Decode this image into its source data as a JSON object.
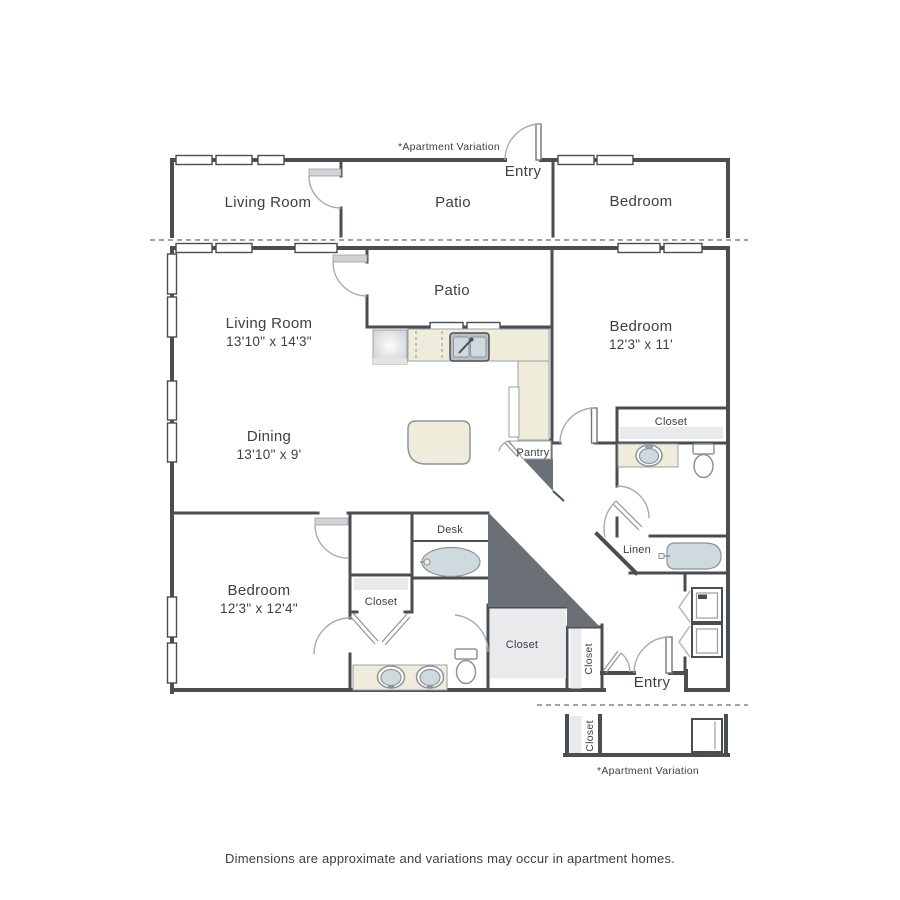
{
  "top_variation": {
    "note": "*Apartment Variation",
    "entry": "Entry",
    "living_room": "Living Room",
    "patio": "Patio",
    "bedroom": "Bedroom"
  },
  "unit": {
    "patio": "Patio",
    "living_room": {
      "name": "Living Room",
      "dims": "13'10\" x 14'3\""
    },
    "dining": {
      "name": "Dining",
      "dims": "13'10\" x 9'"
    },
    "bedroom_right": {
      "name": "Bedroom",
      "dims": "12'3\" x 11'"
    },
    "bedroom_left": {
      "name": "Bedroom",
      "dims": "12'3\" x 12'4\""
    },
    "pantry": "Pantry",
    "desk": "Desk",
    "linen": "Linen",
    "entry": "Entry",
    "closet_bedroom_right": "Closet",
    "closet_bedroom_left": "Closet",
    "closet_walk_in": "Closet",
    "closet_hall": "Closet"
  },
  "bottom_variation": {
    "note": "*Apartment Variation",
    "closet": "Closet"
  },
  "footer": "Dimensions are approximate and variations may occur in apartment homes.",
  "colors": {
    "wall": "#494e53",
    "counter": "#efecdb",
    "fixture_water": "#cfdade",
    "shelving": "#e9eaeb",
    "dead_space": "#6b7076",
    "outline": "#8d9499",
    "text": "#3b4046",
    "separator": "#a0a2a4"
  }
}
